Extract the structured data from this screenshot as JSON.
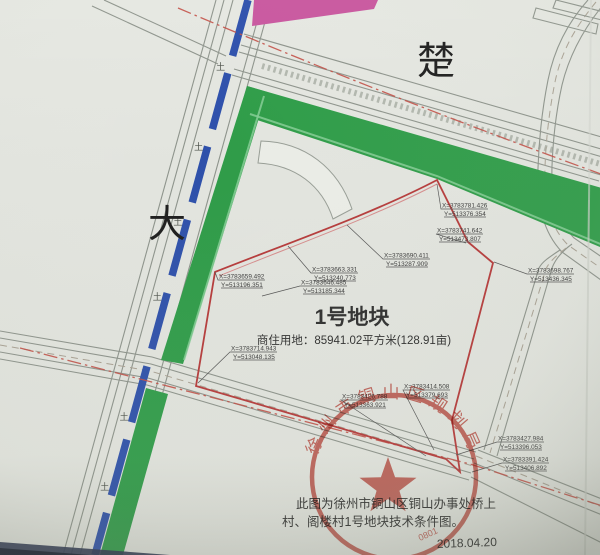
{
  "map": {
    "road_name_top": "楚",
    "road_name_left": "大",
    "parcel": {
      "title": "1号地块",
      "land_use": "商住用地：85941.02平方米(128.91亩)"
    },
    "coordinate_labels": [
      {
        "x": "X=3783781.426",
        "y": "Y=513376.354",
        "lx": 441,
        "ly": 209,
        "tx": 437,
        "ty": 184
      },
      {
        "x": "X=3783741.642",
        "y": "Y=513473.807",
        "lx": 436,
        "ly": 234,
        "tx": 466,
        "ty": 243
      },
      {
        "x": "X=3783698.767",
        "y": "Y=513436.345",
        "lx": 527,
        "ly": 274,
        "tx": 494,
        "ty": 262
      },
      {
        "x": "X=3783690.411",
        "y": "Y=513287.909",
        "lx": 383,
        "ly": 259,
        "tx": 347,
        "ty": 225
      },
      {
        "x": "X=3783663.331",
        "y": "Y=513240.773",
        "lx": 311,
        "ly": 273,
        "tx": 288,
        "ty": 246
      },
      {
        "x": "X=3783659.492",
        "y": "Y=513196.351",
        "lx": 218,
        "ly": 280,
        "tx": 215,
        "ty": 272
      },
      {
        "x": "X=3783646.485",
        "y": "Y=513185.344",
        "lx": 300,
        "ly": 286,
        "tx": 262,
        "ty": 296
      },
      {
        "x": "X=3783714.943",
        "y": "Y=513048.135",
        "lx": 230,
        "ly": 352,
        "tx": 198,
        "ty": 383
      },
      {
        "x": "X=3783414.508",
        "y": "Y=513379.693",
        "lx": 403,
        "ly": 390,
        "tx": 434,
        "ty": 450
      },
      {
        "x": "X=3783426.788",
        "y": "Y=513363.921",
        "lx": 341,
        "ly": 400,
        "tx": 426,
        "ty": 456
      },
      {
        "x": "X=3783427.984",
        "y": "Y=513396.053",
        "lx": 497,
        "ly": 442,
        "tx": 456,
        "ty": 455
      },
      {
        "x": "X=3783391.424",
        "y": "Y=513406.892",
        "lx": 502,
        "ly": 463,
        "tx": 472,
        "ty": 472
      }
    ],
    "survey_mark_glyph": "土",
    "note_line1": "此图为徐州市铜山区铜山办事处桥上",
    "note_line2": "村、阁楼村1号地块技术条件图。",
    "date": "2018.04.20",
    "stamp": {
      "text": "徐州市铜山区规划局",
      "number": "0801"
    },
    "colors": {
      "paper": "#e6e8e2",
      "green_buffer": "#2f9e49",
      "blue_median": "#2e51ad",
      "magenta_parcel": "#c9579f",
      "red_boundary": "#b83a3a",
      "seal_red": "#c5392f"
    }
  }
}
